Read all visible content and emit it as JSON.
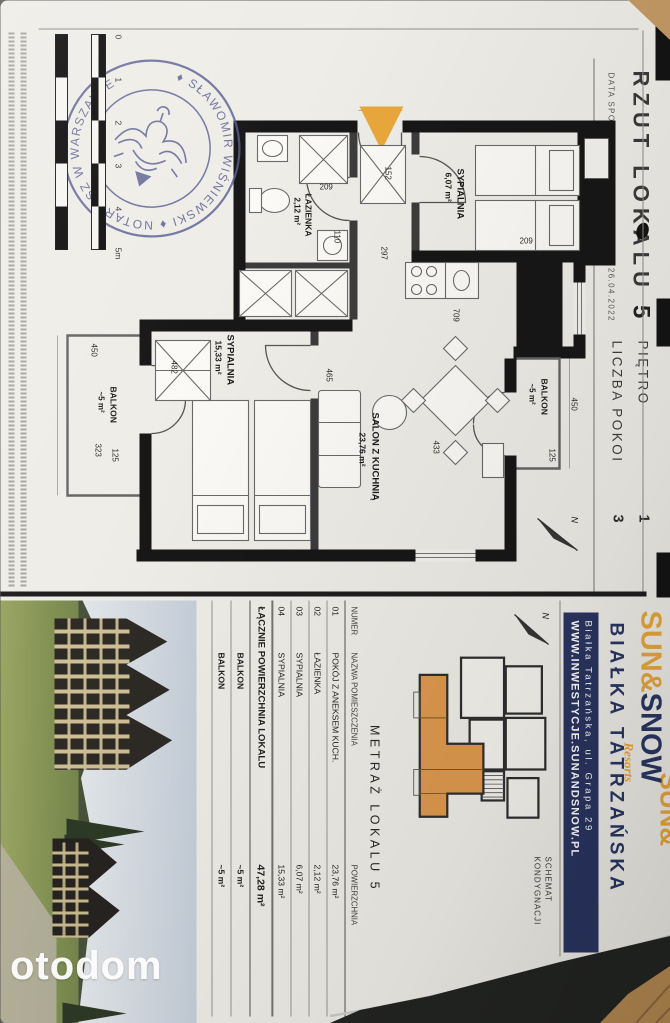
{
  "header": {
    "title_prefix": "RZUT LOKALU",
    "title_number": "5",
    "date_line": "DATA SPORZĄDZENIA KARTY LOKALU: 26.04.2022",
    "floor_label": "PIĘTRO",
    "floor_value": "1",
    "rooms_label": "LICZBA POKOI",
    "rooms_value": "3"
  },
  "plan": {
    "rooms": [
      {
        "name": "SYPIALNIA",
        "area": "6,07 m²"
      },
      {
        "name": "ŁAZIENKA",
        "area": "2,12 m²"
      },
      {
        "name": "SALON Z KUCHNIĄ",
        "area": "23,76 m²"
      },
      {
        "name": "SYPIALNIA",
        "area": "15,33 m²"
      },
      {
        "name": "BALKON",
        "area": "~5 m²"
      },
      {
        "name": "BALKON",
        "area": "~5 m²"
      }
    ],
    "dims": {
      "balcony2_width": "450",
      "balcony2_depth": "125",
      "salon_length": "709",
      "salon_width": "465",
      "salon_diag": "433",
      "bedroom_small_width": "297",
      "bed_length": "209",
      "hall_width": "152",
      "bath_width": "110",
      "bath_length": "209",
      "bedroom_large_length": "482",
      "bedroom_large_width": "323",
      "balcony1_width": "450",
      "balcony1_depth": "125"
    },
    "scale_labels": [
      "0",
      "1",
      "2",
      "3",
      "4",
      "5m"
    ],
    "north": "N",
    "accent_color": "#E9A83C"
  },
  "stamp": {
    "ring_text": "♦ SŁAWOMIR WIŚNIEWSKI ♦ NOTARIUSZ W WARSZAWIE"
  },
  "branding": {
    "logo_part1": "SUN&",
    "logo_part2": "SNOW",
    "logo_part3": "Resorts",
    "location": "BIAŁKA TATRZAŃSKA",
    "address": "Białka Tatrzańska, ul. Grapa 29",
    "website": "WWW.INWESTYCJE.SUNANDSNOW.PL",
    "logo_fragment": "SUN&",
    "navy_color": "#2A3560",
    "orange_color": "#E9A83C"
  },
  "schematic": {
    "caption_line1": "SCHEMAT",
    "caption_line2": "KONDYGNACJI",
    "highlight_color": "#DF9A4F"
  },
  "area_table": {
    "title": "METRAŻ LOKALU 5",
    "columns": [
      "NUMER",
      "NAZWA POMIESZCZENIA",
      "POWIERZCHNIA"
    ],
    "rows": [
      [
        "01",
        "POKÓJ Z ANEKSEM KUCH.",
        "23,76 m²"
      ],
      [
        "02",
        "ŁAZIENKA",
        "2,12 m²"
      ],
      [
        "03",
        "SYPIALNIA",
        "6,07 m²"
      ],
      [
        "04",
        "SYPIALNIA",
        "15,33 m²"
      ]
    ],
    "total_label": "ŁĄCZNIE POWIERZCHNIA LOKALU",
    "total_value": "47,28 m²",
    "balcony_rows": [
      [
        "BALKON",
        "~5 m²"
      ],
      [
        "BALKON",
        "~5 m²"
      ]
    ]
  },
  "watermark": "otodom"
}
